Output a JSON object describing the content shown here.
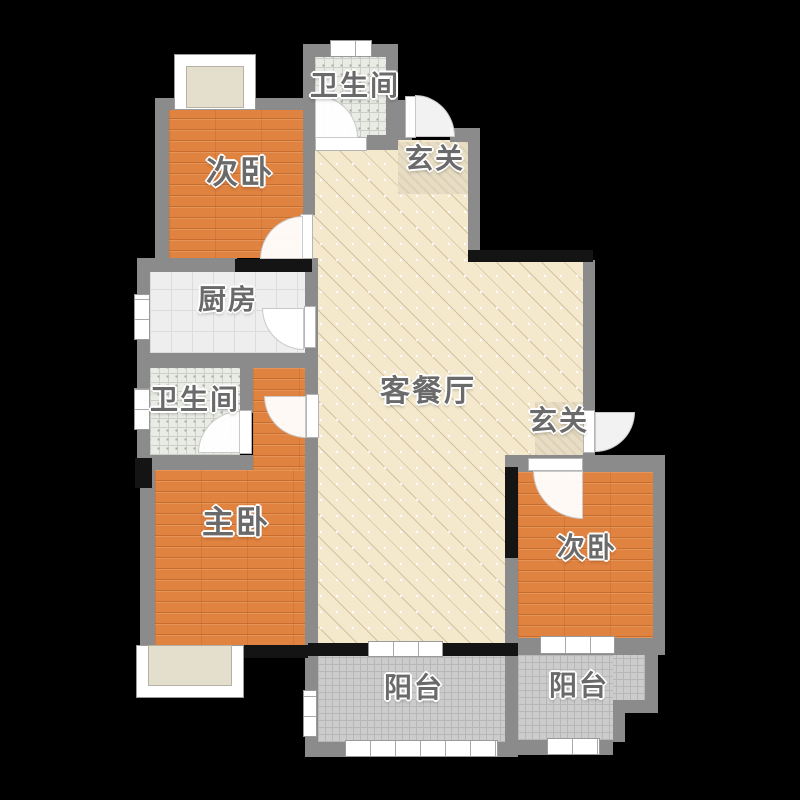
{
  "rooms": [
    {
      "id": "bedroom-top-left",
      "label": "次卧",
      "floor": "wood"
    },
    {
      "id": "bathroom-top",
      "label": "卫生间",
      "floor": "bath-tile"
    },
    {
      "id": "hall-top",
      "label": "玄关",
      "floor": "stone"
    },
    {
      "id": "kitchen",
      "label": "厨房",
      "floor": "kitchen-tile"
    },
    {
      "id": "bathroom-left",
      "label": "卫生间",
      "floor": "bath-tile"
    },
    {
      "id": "living-dining",
      "label": "客餐厅",
      "floor": "ceramic-hatch"
    },
    {
      "id": "hall-right",
      "label": "玄关",
      "floor": "stone"
    },
    {
      "id": "master-bedroom",
      "label": "主卧",
      "floor": "wood"
    },
    {
      "id": "bedroom-right",
      "label": "次卧",
      "floor": "wood"
    },
    {
      "id": "balcony-left",
      "label": "阳台",
      "floor": "mosaic"
    },
    {
      "id": "balcony-right",
      "label": "阳台",
      "floor": "mosaic"
    }
  ],
  "colors": {
    "background": "#000000",
    "wall": "#8b8b8b",
    "wall_load_bearing": "#141414",
    "wood_floor": "#e08240",
    "living_floor": "#f4e9cd",
    "kitchen_tile": "#eeeeee",
    "bath_tile": "#e9ebe5",
    "balcony_tile": "#cccccc",
    "hall_stone": "#e7ddc4",
    "label_text": "#6a6a6a"
  }
}
